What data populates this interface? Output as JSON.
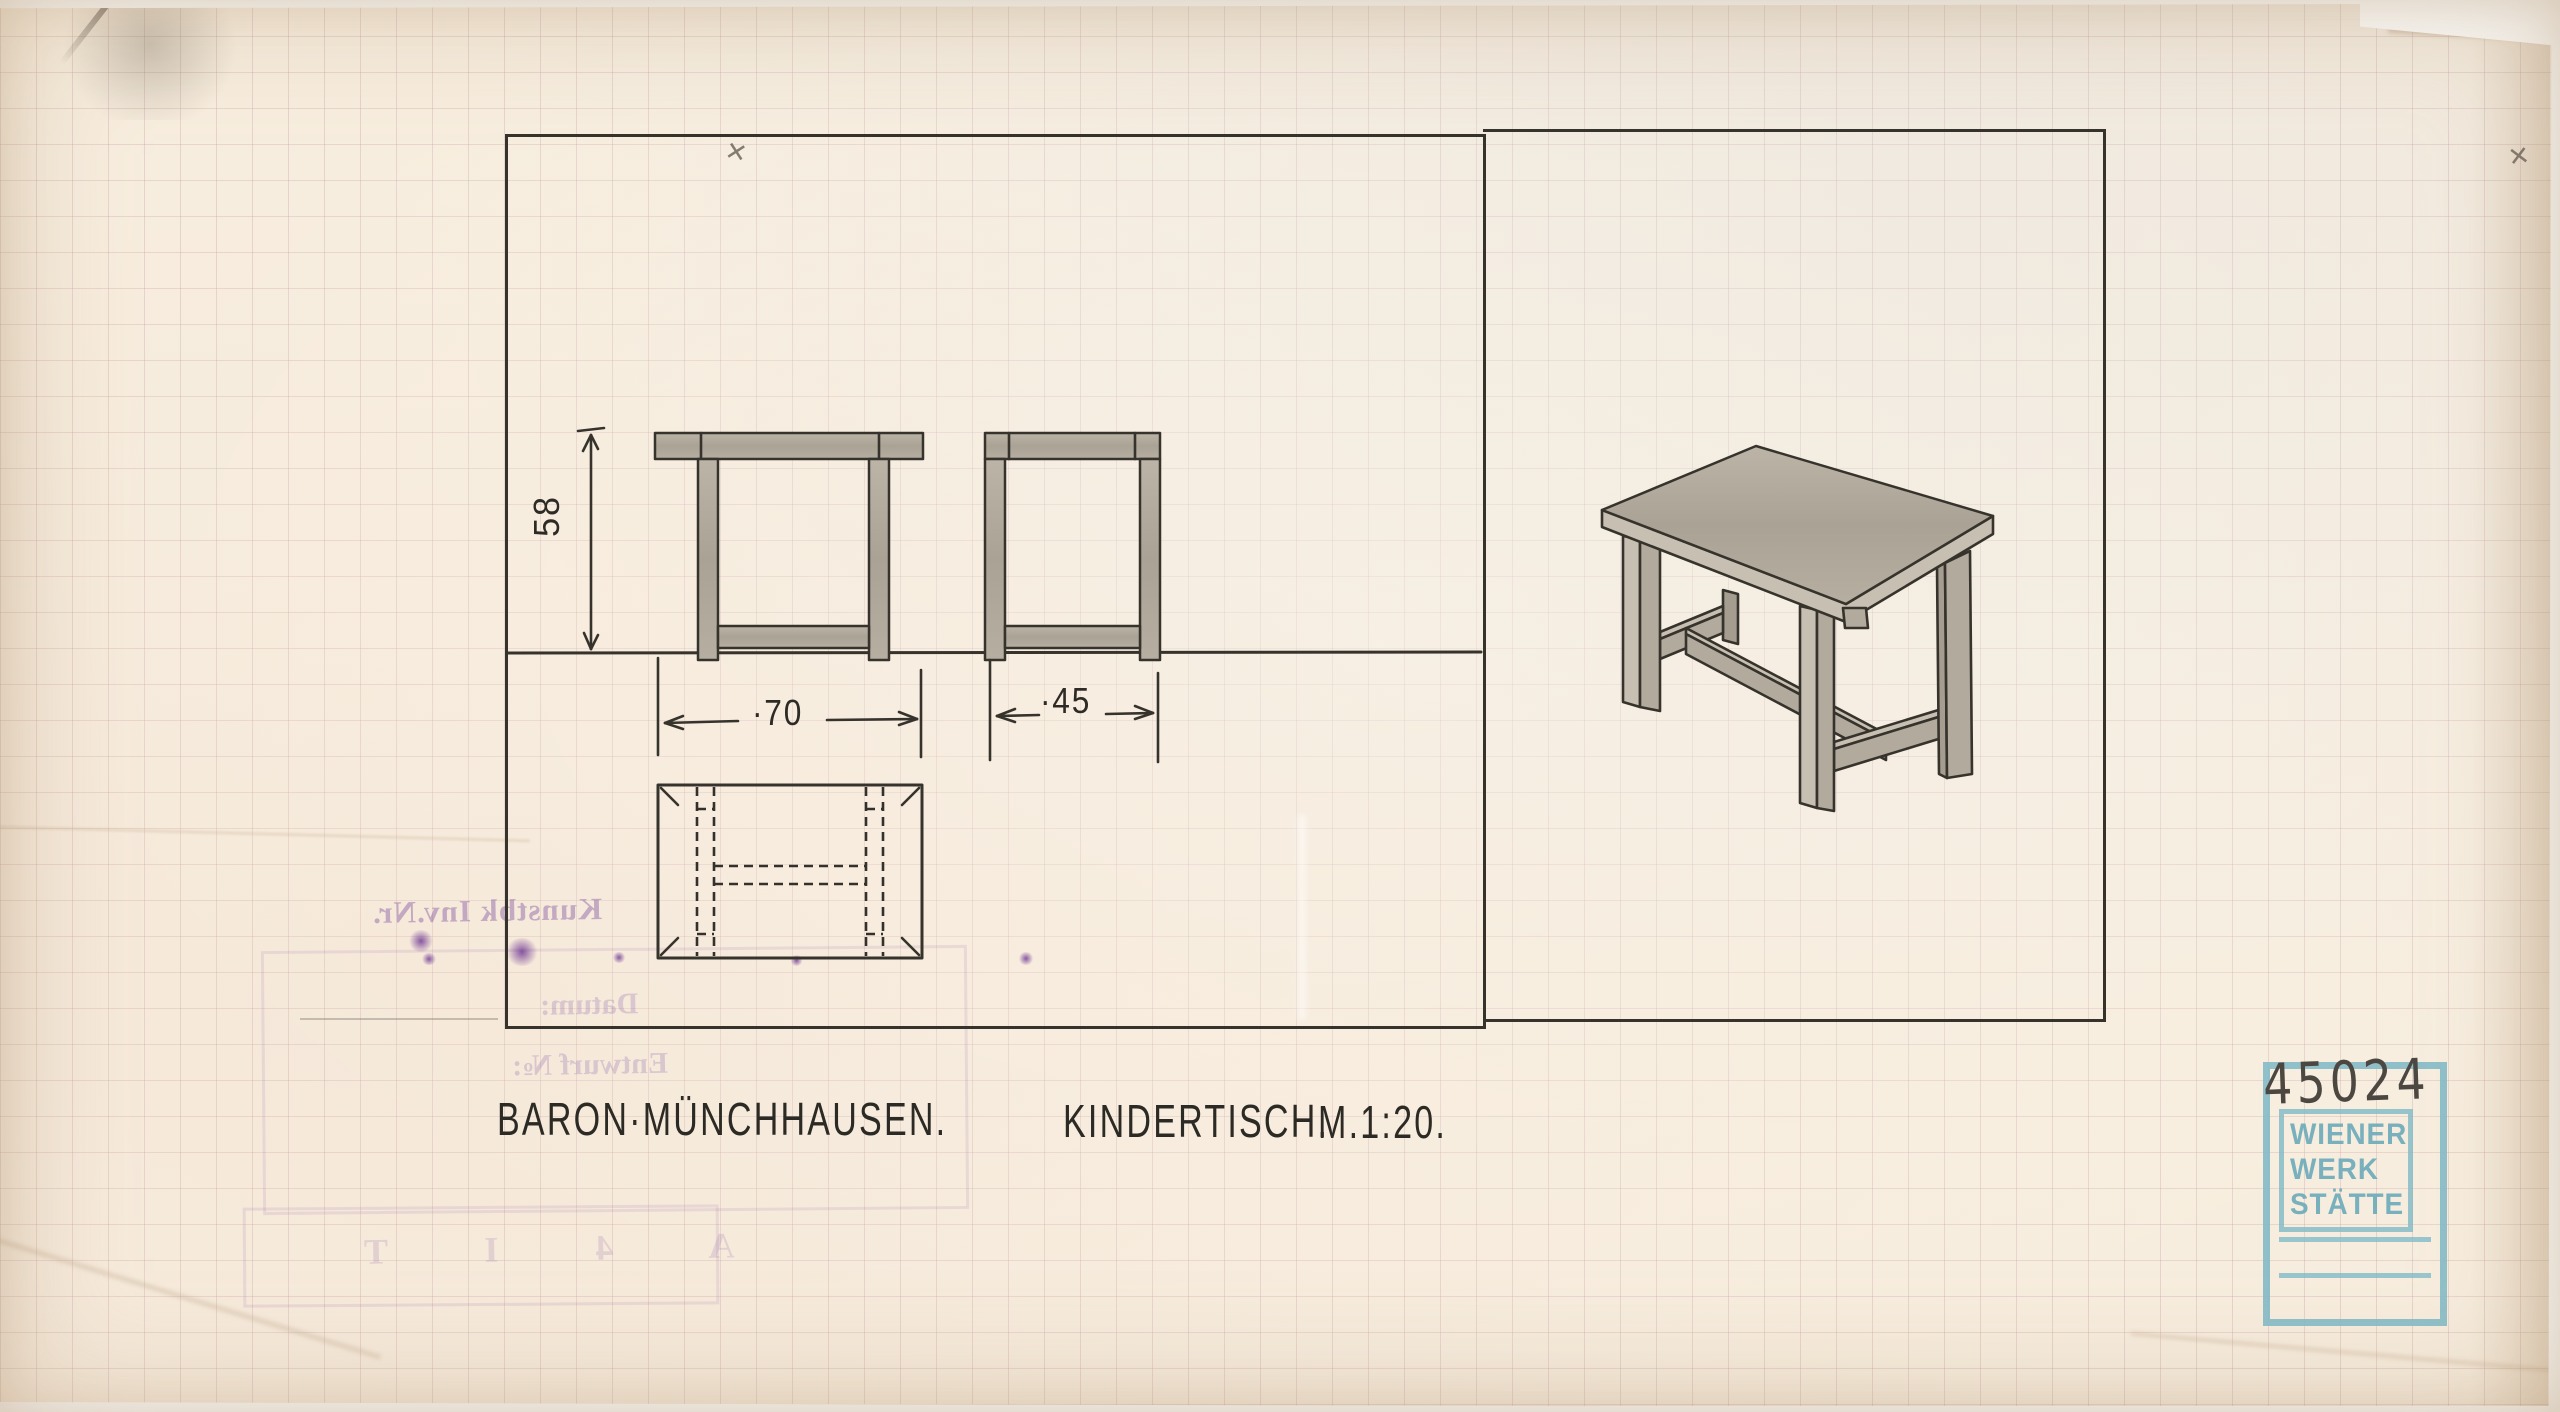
{
  "document": {
    "client": "BARON·MÜNCHHAUSEN.",
    "title": "KINDERTISCH.",
    "scale": "M.1:20.",
    "dim_height": "58",
    "dim_width": "·70",
    "dim_depth": "·45"
  },
  "stamp": {
    "inventory_number": "45024",
    "line1": "WIENER",
    "line2": "WERK",
    "line3": "STÄTTE"
  },
  "verso_bleed": {
    "inventory_label": "Kunstbk Inv.Nr.",
    "date_label": "Datum:",
    "design_label": "Entwurf №:",
    "letter_row": "A 4 I T"
  },
  "annotations": {
    "pencil_mark": "✕"
  },
  "colors": {
    "paper": "#f7edde",
    "ink": "#36332d",
    "pencil_fill": "#b2aa9c",
    "stamp_blue": "#81bac7",
    "bleed_purple": "#7c4f9e"
  }
}
